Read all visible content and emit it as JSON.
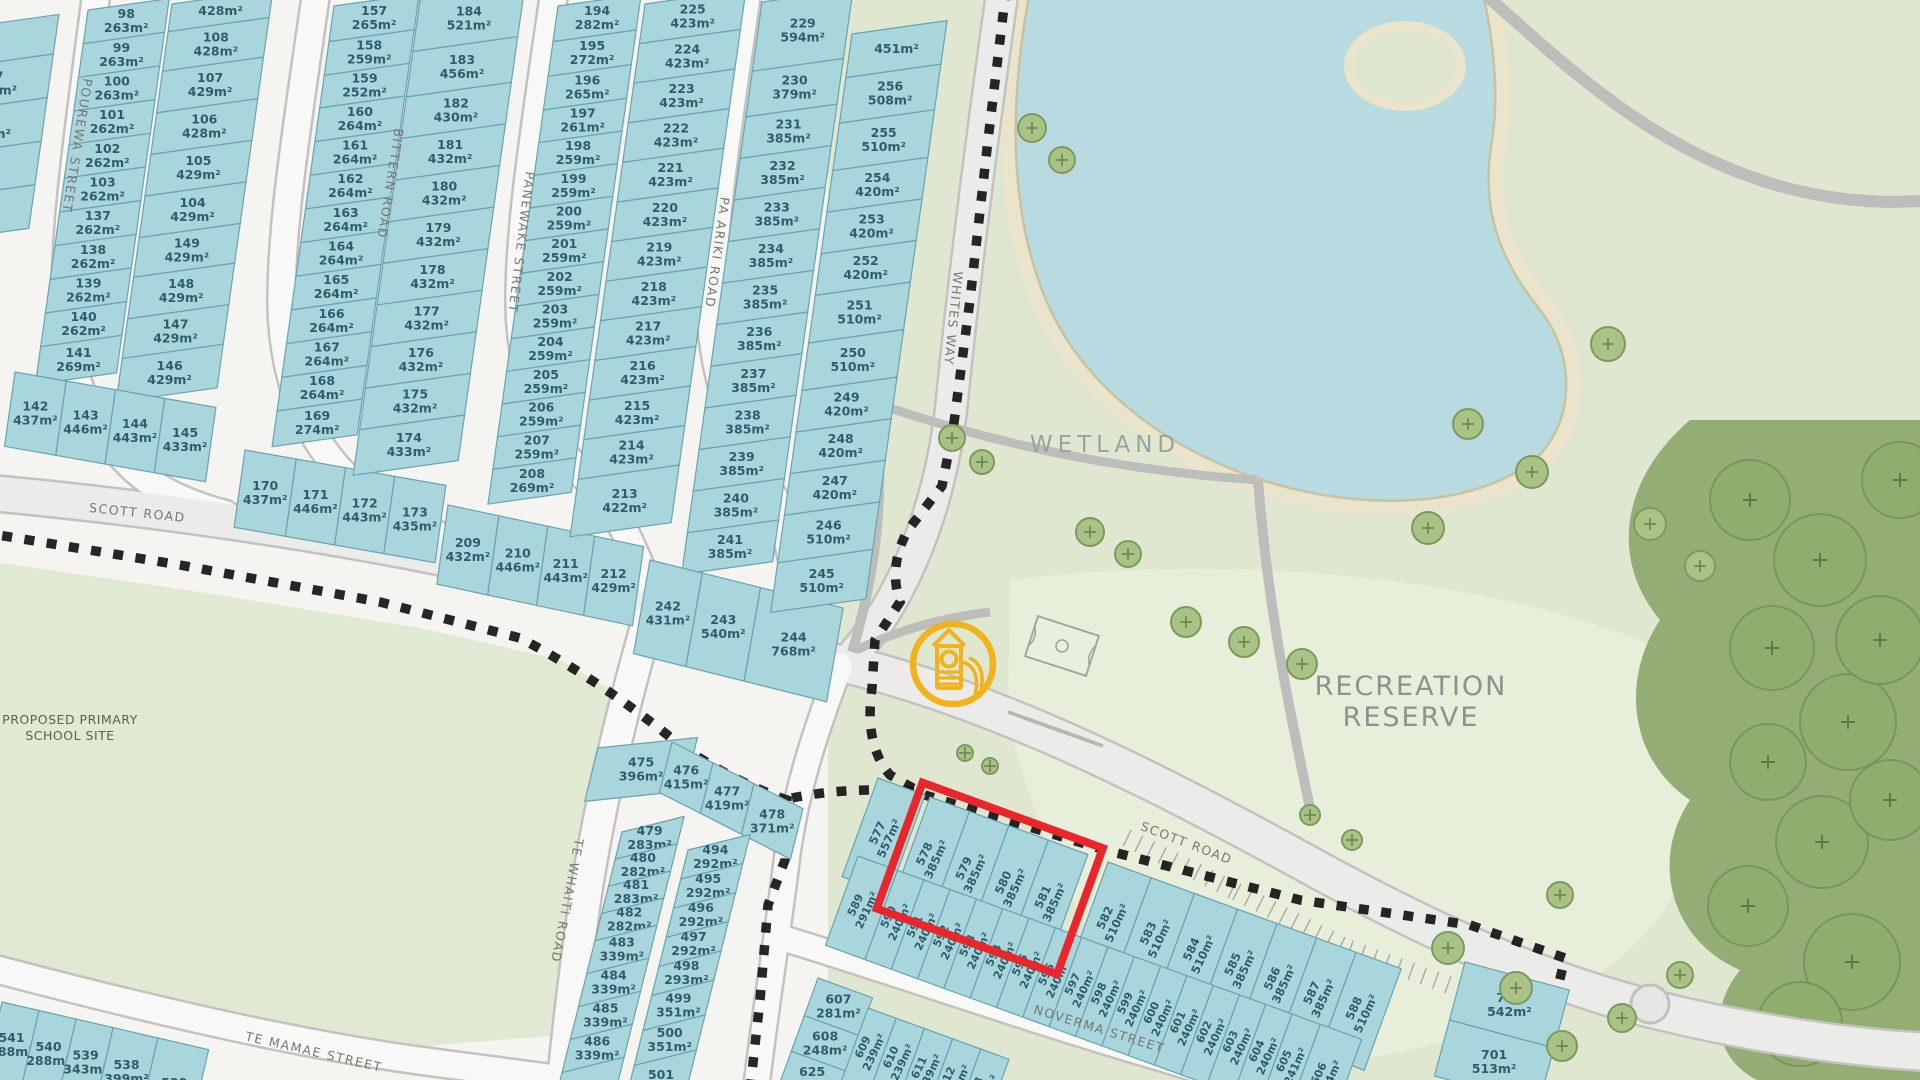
{
  "area_labels": {
    "wetland": "WETLAND",
    "recreation_line1": "RECREATION",
    "recreation_line2": "RESERVE",
    "school_line1": "PROPOSED PRIMARY",
    "school_line2": "SCHOOL SITE"
  },
  "street_labels": [
    {
      "name": "POUREWA STREET",
      "x": 73,
      "y": 145,
      "rot": 99
    },
    {
      "name": "BITTERN ROAD",
      "x": 386,
      "y": 183,
      "rot": 99
    },
    {
      "name": "PANEWAKE STREET",
      "x": 517,
      "y": 242,
      "rot": 97
    },
    {
      "name": "PA ARIKI ROAD",
      "x": 713,
      "y": 252,
      "rot": 98
    },
    {
      "name": "WHITES WAY",
      "x": 949,
      "y": 318,
      "rot": 96
    },
    {
      "name": "SCOTT ROAD",
      "x": 137,
      "y": 517,
      "rot": 6
    },
    {
      "name": "SCOTT ROAD",
      "x": 1185,
      "y": 847,
      "rot": 21
    },
    {
      "name": "TE WHAITI ROAD",
      "x": 563,
      "y": 900,
      "rot": 101
    },
    {
      "name": "TE MAMAE STREET",
      "x": 313,
      "y": 1056,
      "rot": 13
    },
    {
      "name": "NOVERMA STREET",
      "x": 1098,
      "y": 1033,
      "rot": 17
    }
  ],
  "highlight": {
    "o": [
      930,
      797
    ],
    "rowA": 20,
    "colA": 110,
    "length": 192,
    "depth": 134,
    "color": "#e8262b",
    "lots": [
      "578",
      "579",
      "580",
      "581"
    ]
  },
  "playground_icon": {
    "x": 953,
    "y": 664,
    "r": 40,
    "color": "#f2b21c"
  },
  "colors": {
    "lot_fill": "#a9d5dc",
    "lot_stroke": "#69a3af",
    "lot_text": "#2f5e6b",
    "reserve": "#dfe7d0",
    "lawn": "#e7efdb",
    "water": "#b7dbe0",
    "sand": "#e9e4cb",
    "road": "#f8f8f6",
    "road_major": "#ebebe9",
    "road_casing": "#c3c2bf",
    "boundary": "#141414",
    "forest": "#94ad74",
    "tree": "#a9c386",
    "tree_dark": "#8fae6d"
  },
  "lot_groups": [
    {
      "name": "block-west-edge",
      "dir": "col",
      "o": [
        -52,
        30
      ],
      "rowA": -8,
      "colA": 98,
      "w": 112,
      "lots": [
        [
          "",
          "",
          40
        ],
        [
          "77",
          "386m²",
          44
        ],
        [
          "76",
          "387m²",
          44
        ],
        [
          "",
          "",
          44
        ],
        [
          "",
          "",
          44
        ]
      ]
    },
    {
      "name": "column-98",
      "dir": "col",
      "o": [
        88,
        10
      ],
      "rowA": -8,
      "colA": 98,
      "w": 82,
      "lots": [
        [
          "98",
          "263m²",
          34
        ],
        [
          "99",
          "263m²",
          34
        ],
        [
          "100",
          "263m²",
          34
        ],
        [
          "101",
          "262m²",
          34
        ],
        [
          "102",
          "262m²",
          34
        ],
        [
          "103",
          "262m²",
          34
        ],
        [
          "137",
          "262m²",
          34
        ],
        [
          "138",
          "262m²",
          34
        ],
        [
          "139",
          "262m²",
          34
        ],
        [
          "140",
          "262m²",
          34
        ],
        [
          "141",
          "269m²",
          38
        ]
      ]
    },
    {
      "name": "column-108",
      "dir": "col",
      "o": [
        172,
        4
      ],
      "rowA": -8,
      "colA": 98,
      "w": 102,
      "lots": [
        [
          "",
          "428m²",
          28
        ],
        [
          "108",
          "428m²",
          40
        ],
        [
          "107",
          "429m²",
          42
        ],
        [
          "106",
          "428m²",
          42
        ],
        [
          "105",
          "429m²",
          42
        ],
        [
          "104",
          "429m²",
          42
        ],
        [
          "149",
          "429m²",
          40
        ],
        [
          "148",
          "429m²",
          42
        ],
        [
          "147",
          "429m²",
          40
        ],
        [
          "146",
          "429m²",
          44
        ]
      ]
    },
    {
      "name": "row-142",
      "dir": "row",
      "o": [
        15,
        372
      ],
      "rowA": 10,
      "colA": 98,
      "h": 75,
      "lots": [
        [
          "142",
          "437m²",
          52
        ],
        [
          "143",
          "446m²",
          50
        ],
        [
          "144",
          "443m²",
          50
        ],
        [
          "145",
          "433m²",
          52
        ]
      ]
    },
    {
      "name": "column-157",
      "dir": "col",
      "o": [
        334,
        6
      ],
      "rowA": -8,
      "colA": 98,
      "w": 86,
      "lots": [
        [
          "157",
          "265m²",
          36
        ],
        [
          "158",
          "259m²",
          34
        ],
        [
          "159",
          "252m²",
          33
        ],
        [
          "160",
          "264m²",
          34
        ],
        [
          "161",
          "264m²",
          34
        ],
        [
          "162",
          "264m²",
          34
        ],
        [
          "163",
          "264m²",
          34
        ],
        [
          "164",
          "264m²",
          34
        ],
        [
          "165",
          "264m²",
          34
        ],
        [
          "166",
          "264m²",
          34
        ],
        [
          "167",
          "264m²",
          34
        ],
        [
          "168",
          "264m²",
          34
        ],
        [
          "169",
          "274m²",
          36
        ]
      ]
    },
    {
      "name": "row-170",
      "dir": "row",
      "o": [
        245,
        450
      ],
      "rowA": 10,
      "colA": 98,
      "h": 78,
      "lots": [
        [
          "170",
          "437m²",
          52
        ],
        [
          "171",
          "446m²",
          50
        ],
        [
          "172",
          "443m²",
          50
        ],
        [
          "173",
          "435m²",
          52
        ]
      ]
    },
    {
      "name": "column-184",
      "dir": "col",
      "o": [
        420,
        0
      ],
      "rowA": -8,
      "colA": 98,
      "w": 106,
      "lots": [
        [
          "184",
          "521m²",
          52
        ],
        [
          "183",
          "456m²",
          46
        ],
        [
          "182",
          "430m²",
          42
        ],
        [
          "181",
          "432m²",
          42
        ],
        [
          "180",
          "432m²",
          42
        ],
        [
          "179",
          "432m²",
          42
        ],
        [
          "178",
          "432m²",
          42
        ],
        [
          "177",
          "432m²",
          42
        ],
        [
          "176",
          "432m²",
          42
        ],
        [
          "175",
          "432m²",
          42
        ],
        [
          "174",
          "433m²",
          46
        ]
      ]
    },
    {
      "name": "column-194",
      "dir": "col",
      "o": [
        558,
        6
      ],
      "rowA": -8,
      "colA": 98,
      "w": 84,
      "lots": [
        [
          "194",
          "282m²",
          36
        ],
        [
          "195",
          "272m²",
          35
        ],
        [
          "196",
          "265m²",
          34
        ],
        [
          "197",
          "261m²",
          33
        ],
        [
          "198",
          "259m²",
          33
        ],
        [
          "199",
          "259m²",
          33
        ],
        [
          "200",
          "259m²",
          33
        ],
        [
          "201",
          "259m²",
          33
        ],
        [
          "202",
          "259m²",
          33
        ],
        [
          "203",
          "259m²",
          33
        ],
        [
          "204",
          "259m²",
          33
        ],
        [
          "205",
          "259m²",
          33
        ],
        [
          "206",
          "259m²",
          33
        ],
        [
          "207",
          "259m²",
          33
        ],
        [
          "208",
          "269m²",
          35
        ]
      ]
    },
    {
      "name": "row-209",
      "dir": "row",
      "o": [
        448,
        505
      ],
      "rowA": 12,
      "colA": 98,
      "h": 80,
      "lots": [
        [
          "209",
          "432m²",
          52
        ],
        [
          "210",
          "446m²",
          50
        ],
        [
          "211",
          "443m²",
          48
        ],
        [
          "212",
          "429m²",
          50
        ]
      ]
    },
    {
      "name": "column-225",
      "dir": "col",
      "o": [
        645,
        4
      ],
      "rowA": -8,
      "colA": 98,
      "w": 102,
      "lots": [
        [
          "225",
          "423m²",
          40
        ],
        [
          "224",
          "423m²",
          40
        ],
        [
          "223",
          "423m²",
          40
        ],
        [
          "222",
          "423m²",
          40
        ],
        [
          "221",
          "423m²",
          40
        ],
        [
          "220",
          "423m²",
          40
        ],
        [
          "219",
          "423m²",
          40
        ],
        [
          "218",
          "423m²",
          40
        ],
        [
          "217",
          "423m²",
          40
        ],
        [
          "216",
          "423m²",
          40
        ],
        [
          "215",
          "423m²",
          40
        ],
        [
          "214",
          "423m²",
          40
        ],
        [
          "213",
          "422m²",
          58
        ]
      ]
    },
    {
      "name": "column-229",
      "dir": "col",
      "o": [
        762,
        2
      ],
      "rowA": -8,
      "colA": 98,
      "w": 92,
      "lots": [
        [
          "229",
          "594m²",
          70
        ],
        [
          "230",
          "379m²",
          46
        ],
        [
          "231",
          "385m²",
          42
        ],
        [
          "232",
          "385m²",
          42
        ],
        [
          "233",
          "385m²",
          42
        ],
        [
          "234",
          "385m²",
          42
        ],
        [
          "235",
          "385m²",
          42
        ],
        [
          "236",
          "385m²",
          42
        ],
        [
          "237",
          "385m²",
          42
        ],
        [
          "238",
          "385m²",
          42
        ],
        [
          "239",
          "385m²",
          42
        ],
        [
          "240",
          "385m²",
          42
        ],
        [
          "241",
          "385m²",
          42
        ]
      ]
    },
    {
      "name": "row-242",
      "dir": "row",
      "o": [
        650,
        560
      ],
      "rowA": 14,
      "colA": 100,
      "h": 95,
      "lots": [
        [
          "242",
          "431m²",
          54
        ],
        [
          "243",
          "540m²",
          60
        ],
        [
          "244",
          "768m²",
          85
        ]
      ]
    },
    {
      "name": "column-256",
      "dir": "col",
      "o": [
        852,
        34
      ],
      "rowA": -8,
      "colA": 98,
      "w": 96,
      "lots": [
        [
          "",
          "451m²",
          44
        ],
        [
          "256",
          "508m²",
          46
        ],
        [
          "255",
          "510m²",
          48
        ],
        [
          "254",
          "420m²",
          42
        ],
        [
          "253",
          "420m²",
          42
        ],
        [
          "252",
          "420m²",
          42
        ],
        [
          "251",
          "510m²",
          48
        ],
        [
          "250",
          "510m²",
          48
        ],
        [
          "249",
          "420m²",
          42
        ],
        [
          "248",
          "420m²",
          42
        ],
        [
          "247",
          "420m²",
          42
        ],
        [
          "246",
          "510m²",
          48
        ],
        [
          "245",
          "510m²",
          50
        ]
      ]
    },
    {
      "name": "lot-475",
      "dir": "row",
      "o": [
        598,
        748
      ],
      "rowA": -6,
      "colA": 104,
      "h": 55,
      "lots": [
        [
          "475",
          "396m²",
          100
        ]
      ]
    },
    {
      "name": "row-476",
      "dir": "row",
      "o": [
        672,
        742
      ],
      "rowA": 27,
      "colA": 104,
      "h": 52,
      "lots": [
        [
          "476",
          "415m²",
          46
        ],
        [
          "477",
          "419m²",
          46
        ],
        [
          "478",
          "371m²",
          55
        ]
      ]
    },
    {
      "name": "column-479",
      "dir": "col",
      "o": [
        622,
        832
      ],
      "rowA": -14,
      "colA": 104,
      "w": 64,
      "lots": [
        [
          "479",
          "283m²",
          28
        ],
        [
          "480",
          "282m²",
          28
        ],
        [
          "481",
          "283m²",
          28
        ],
        [
          "482",
          "282m²",
          28
        ],
        [
          "483",
          "339m²",
          34
        ],
        [
          "484",
          "339m²",
          34
        ],
        [
          "485",
          "339m²",
          34
        ],
        [
          "486",
          "339m²",
          34
        ],
        [
          "",
          "",
          36
        ]
      ]
    },
    {
      "name": "column-494",
      "dir": "col",
      "o": [
        688,
        850
      ],
      "rowA": -14,
      "colA": 104,
      "w": 64,
      "lots": [
        [
          "494",
          "292m²",
          30
        ],
        [
          "495",
          "292m²",
          30
        ],
        [
          "496",
          "292m²",
          30
        ],
        [
          "497",
          "292m²",
          30
        ],
        [
          "498",
          "293m²",
          30
        ],
        [
          "499",
          "351m²",
          36
        ],
        [
          "500",
          "351m²",
          36
        ],
        [
          "501",
          "",
          36
        ]
      ]
    },
    {
      "name": "lot-577",
      "dir": "row",
      "o": [
        878,
        778
      ],
      "rowA": 20,
      "colA": 110,
      "h": 105,
      "textRot": -65,
      "fs": 11.5,
      "lots": [
        [
          "577",
          "557m²",
          50
        ]
      ]
    },
    {
      "name": "row-578",
      "dir": "row",
      "o": [
        930,
        797
      ],
      "rowA": 20,
      "colA": 110,
      "h": 112,
      "textRot": -65,
      "fs": 11.5,
      "lots": [
        [
          "578",
          "385m²",
          42
        ],
        [
          "579",
          "385m²",
          42
        ],
        [
          "580",
          "385m²",
          42
        ],
        [
          "581",
          "385m²",
          42
        ]
      ]
    },
    {
      "name": "row-582",
      "dir": "row",
      "o": [
        1108,
        862
      ],
      "rowA": 20,
      "colA": 110,
      "h": 108,
      "textRot": -65,
      "fs": 11.5,
      "lots": [
        [
          "582",
          "510m²",
          46
        ],
        [
          "583",
          "510m²",
          46
        ],
        [
          "584",
          "510m²",
          46
        ],
        [
          "585",
          "385m²",
          42
        ],
        [
          "586",
          "385m²",
          42
        ],
        [
          "587",
          "385m²",
          42
        ],
        [
          "588",
          "510m²",
          48
        ]
      ]
    },
    {
      "name": "row-589",
      "dir": "row",
      "o": [
        858,
        856
      ],
      "rowA": 20,
      "colA": 110,
      "h": 95,
      "textRot": -65,
      "fs": 11,
      "lots": [
        [
          "589",
          "291m²",
          42
        ],
        [
          "590",
          "240m²",
          28
        ],
        [
          "591",
          "240m²",
          28
        ],
        [
          "592",
          "240m²",
          28
        ],
        [
          "593",
          "240m²",
          28
        ],
        [
          "594",
          "240m²",
          28
        ],
        [
          "595",
          "240m²",
          28
        ],
        [
          "596",
          "240m²",
          28
        ],
        [
          "597",
          "240m²",
          28
        ],
        [
          "598",
          "240m²",
          28
        ],
        [
          "599",
          "240m²",
          28
        ],
        [
          "600",
          "240m²",
          28
        ],
        [
          "601",
          "240m²",
          28
        ],
        [
          "602",
          "240m²",
          28
        ],
        [
          "603",
          "240m²",
          28
        ],
        [
          "604",
          "240m²",
          28
        ],
        [
          "605",
          "241m²",
          30
        ],
        [
          "606",
          "314m²",
          44
        ]
      ]
    },
    {
      "name": "column-607",
      "dir": "col",
      "o": [
        818,
        978
      ],
      "rowA": 20,
      "colA": 110,
      "w": 58,
      "lots": [
        [
          "607",
          "281m²",
          40
        ],
        [
          "608",
          "248m²",
          38
        ],
        [
          "625",
          "248m²",
          38
        ]
      ]
    },
    {
      "name": "row-609",
      "dir": "row",
      "o": [
        868,
        1008
      ],
      "rowA": 20,
      "colA": 110,
      "h": 78,
      "textRot": -65,
      "fs": 11,
      "lots": [
        [
          "609",
          "239m²",
          30
        ],
        [
          "610",
          "239m²",
          30
        ],
        [
          "611",
          "239m²",
          30
        ],
        [
          "612",
          "239m²",
          30
        ],
        [
          "613",
          "239m²",
          30
        ]
      ]
    },
    {
      "name": "block-700",
      "dir": "col",
      "o": [
        1465,
        962
      ],
      "rowA": 15,
      "colA": 105,
      "w": 108,
      "lots": [
        [
          "700",
          "542m²",
          60
        ],
        [
          "701",
          "513m²",
          58
        ]
      ]
    },
    {
      "name": "row-541",
      "dir": "row",
      "o": [
        2,
        1002
      ],
      "rowA": 13,
      "colA": 103,
      "h": 80,
      "lots": [
        [
          "541",
          "288m²",
          38
        ],
        [
          "540",
          "288m²",
          38
        ],
        [
          "539",
          "343m²",
          38
        ],
        [
          "538",
          "399m²",
          46
        ],
        [
          "530",
          "",
          52
        ]
      ]
    }
  ]
}
